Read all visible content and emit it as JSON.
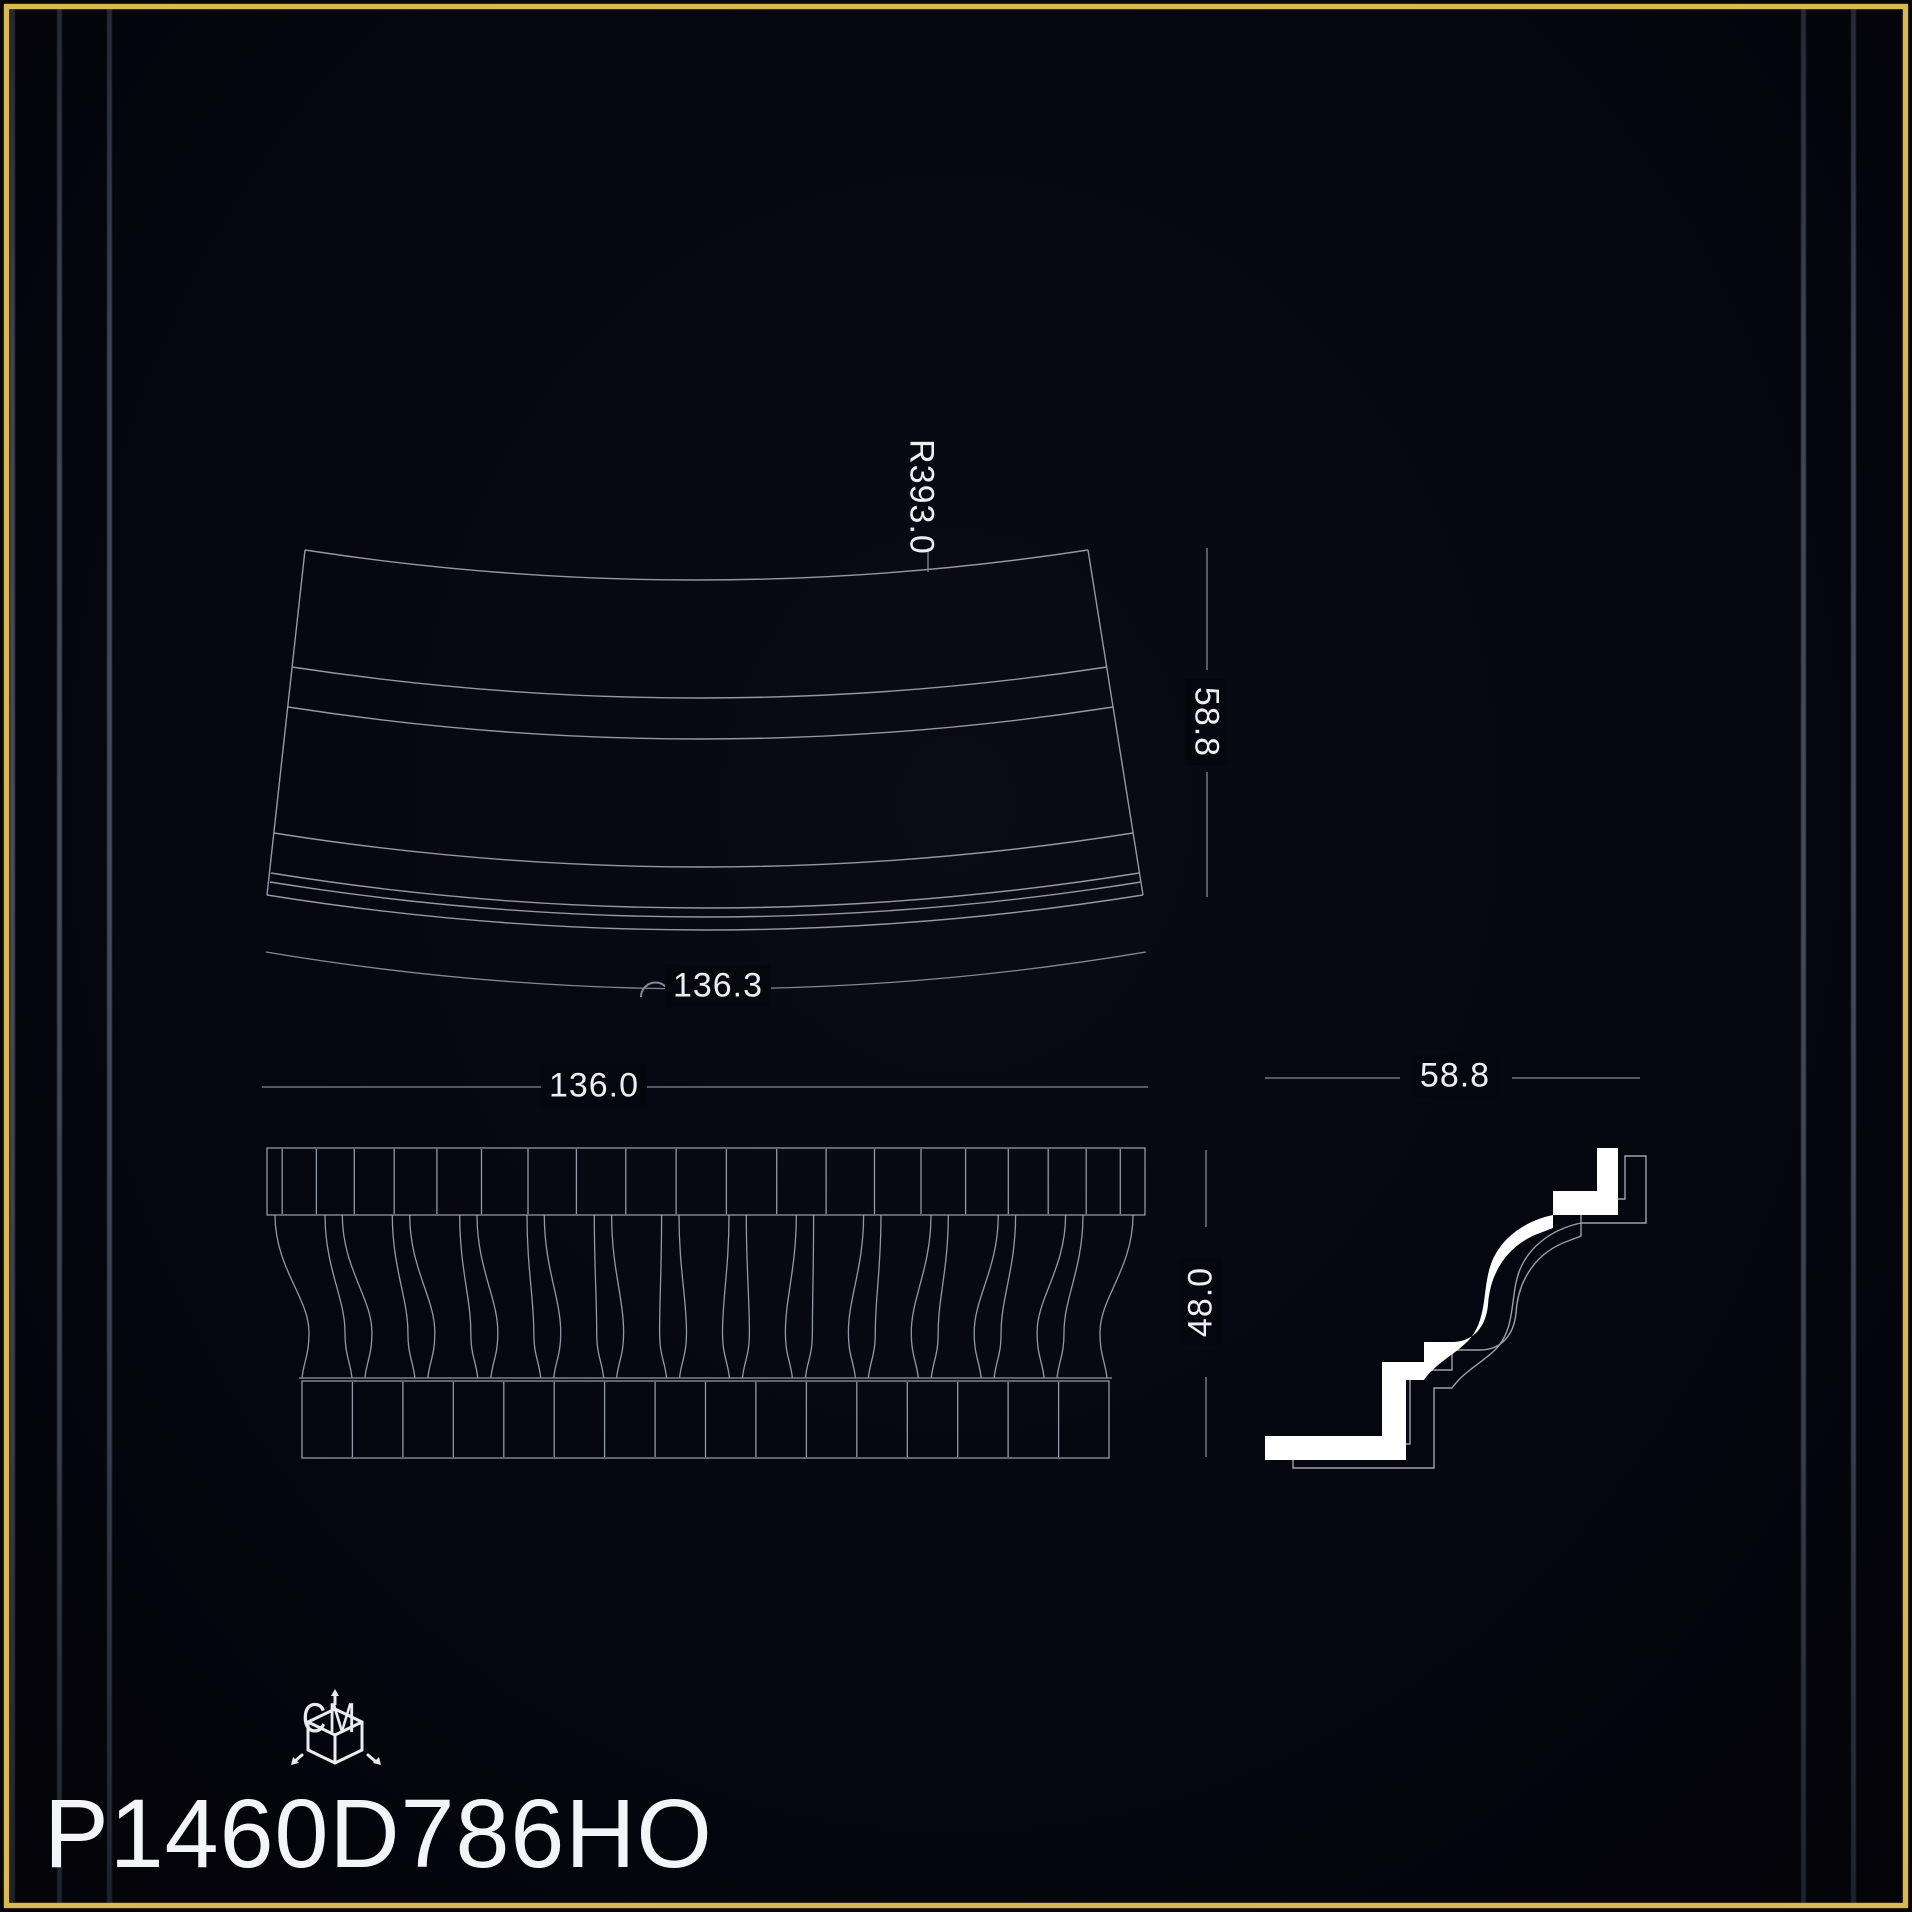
{
  "sheet": {
    "background_color": "#06060f",
    "frame_color": "#d9b954",
    "line_color": "#9298a4",
    "dim_line_color": "#848995",
    "dim_text_color": "#edeff4",
    "profile_fill_color": "#ffffff",
    "product_code": "P1460D786HO",
    "unit_label": "CM",
    "unit_icon": "measure-cube-icon"
  },
  "dimensions": {
    "top_view_radius": "R393.0",
    "top_view_depth": "58.8",
    "top_view_arc_length": "136.3",
    "front_view_width": "136.0",
    "front_view_height": "48.0",
    "profile_depth": "58.8"
  }
}
